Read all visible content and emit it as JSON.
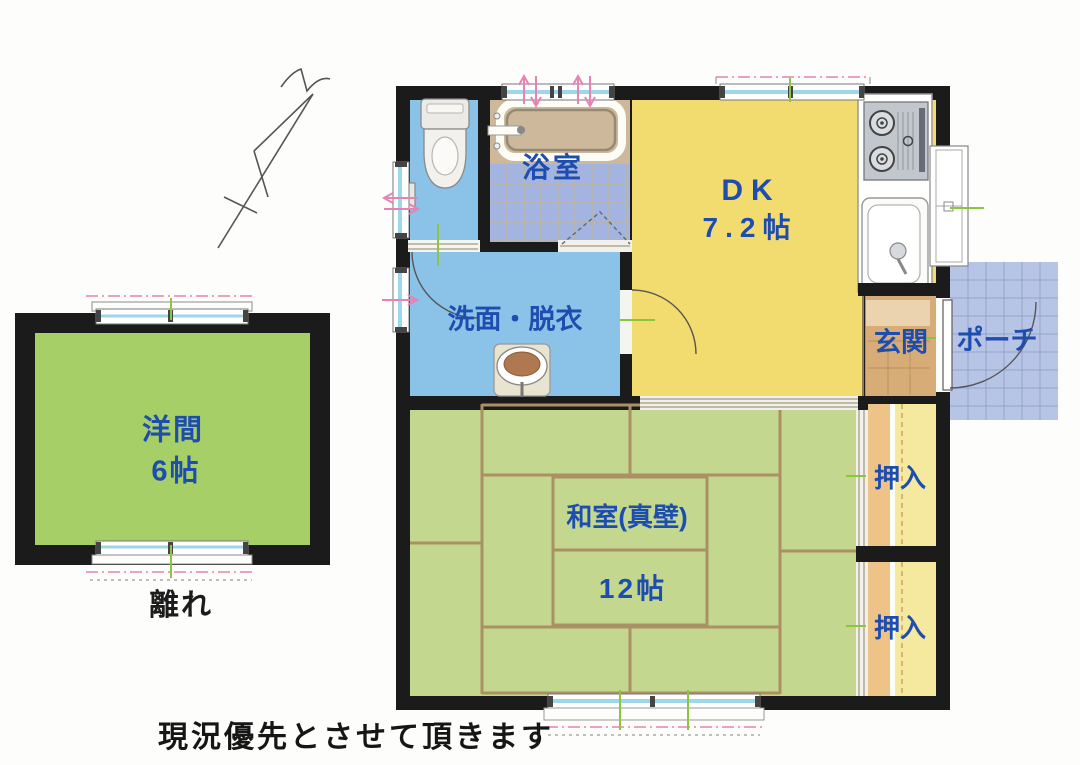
{
  "note": {
    "text": "現況優先とさせて頂きます"
  },
  "annex": {
    "name": "離れ",
    "room": {
      "label": "洋間",
      "size": "6帖"
    }
  },
  "rooms": {
    "bathroom": {
      "label": "浴室"
    },
    "dk": {
      "label": "DK",
      "size": "7.2帖"
    },
    "washroom": {
      "label": "洗面・脱衣"
    },
    "entrance": {
      "label": "玄関"
    },
    "porch": {
      "label": "ポーチ"
    },
    "japanese_room": {
      "label": "和室(真壁)",
      "size": "12帖"
    },
    "closet_upper": {
      "label": "押入"
    },
    "closet_lower": {
      "label": "押入"
    }
  },
  "colors": {
    "wall": "#1b1b1b",
    "label_blue": "#1e4db0",
    "dk_yellow": "#f3dc6f",
    "tatami_green": "#c3d88e",
    "annex_green": "#a6cf67",
    "water_blue": "#8ac2e8",
    "bath_tile_blue": "#a2b4df",
    "porch_blue": "#b7c4e6",
    "entrance_tan": "#d8ac77",
    "closet_tan": "#eec387",
    "closet_yellow": "#f5e9a0",
    "bath_deck_tan": "#cdb89b",
    "tatami_line": "#ab9066",
    "window_glass": "#9ed7ea",
    "pink_marker": "#e882b4",
    "green_marker": "#8cc63f"
  }
}
